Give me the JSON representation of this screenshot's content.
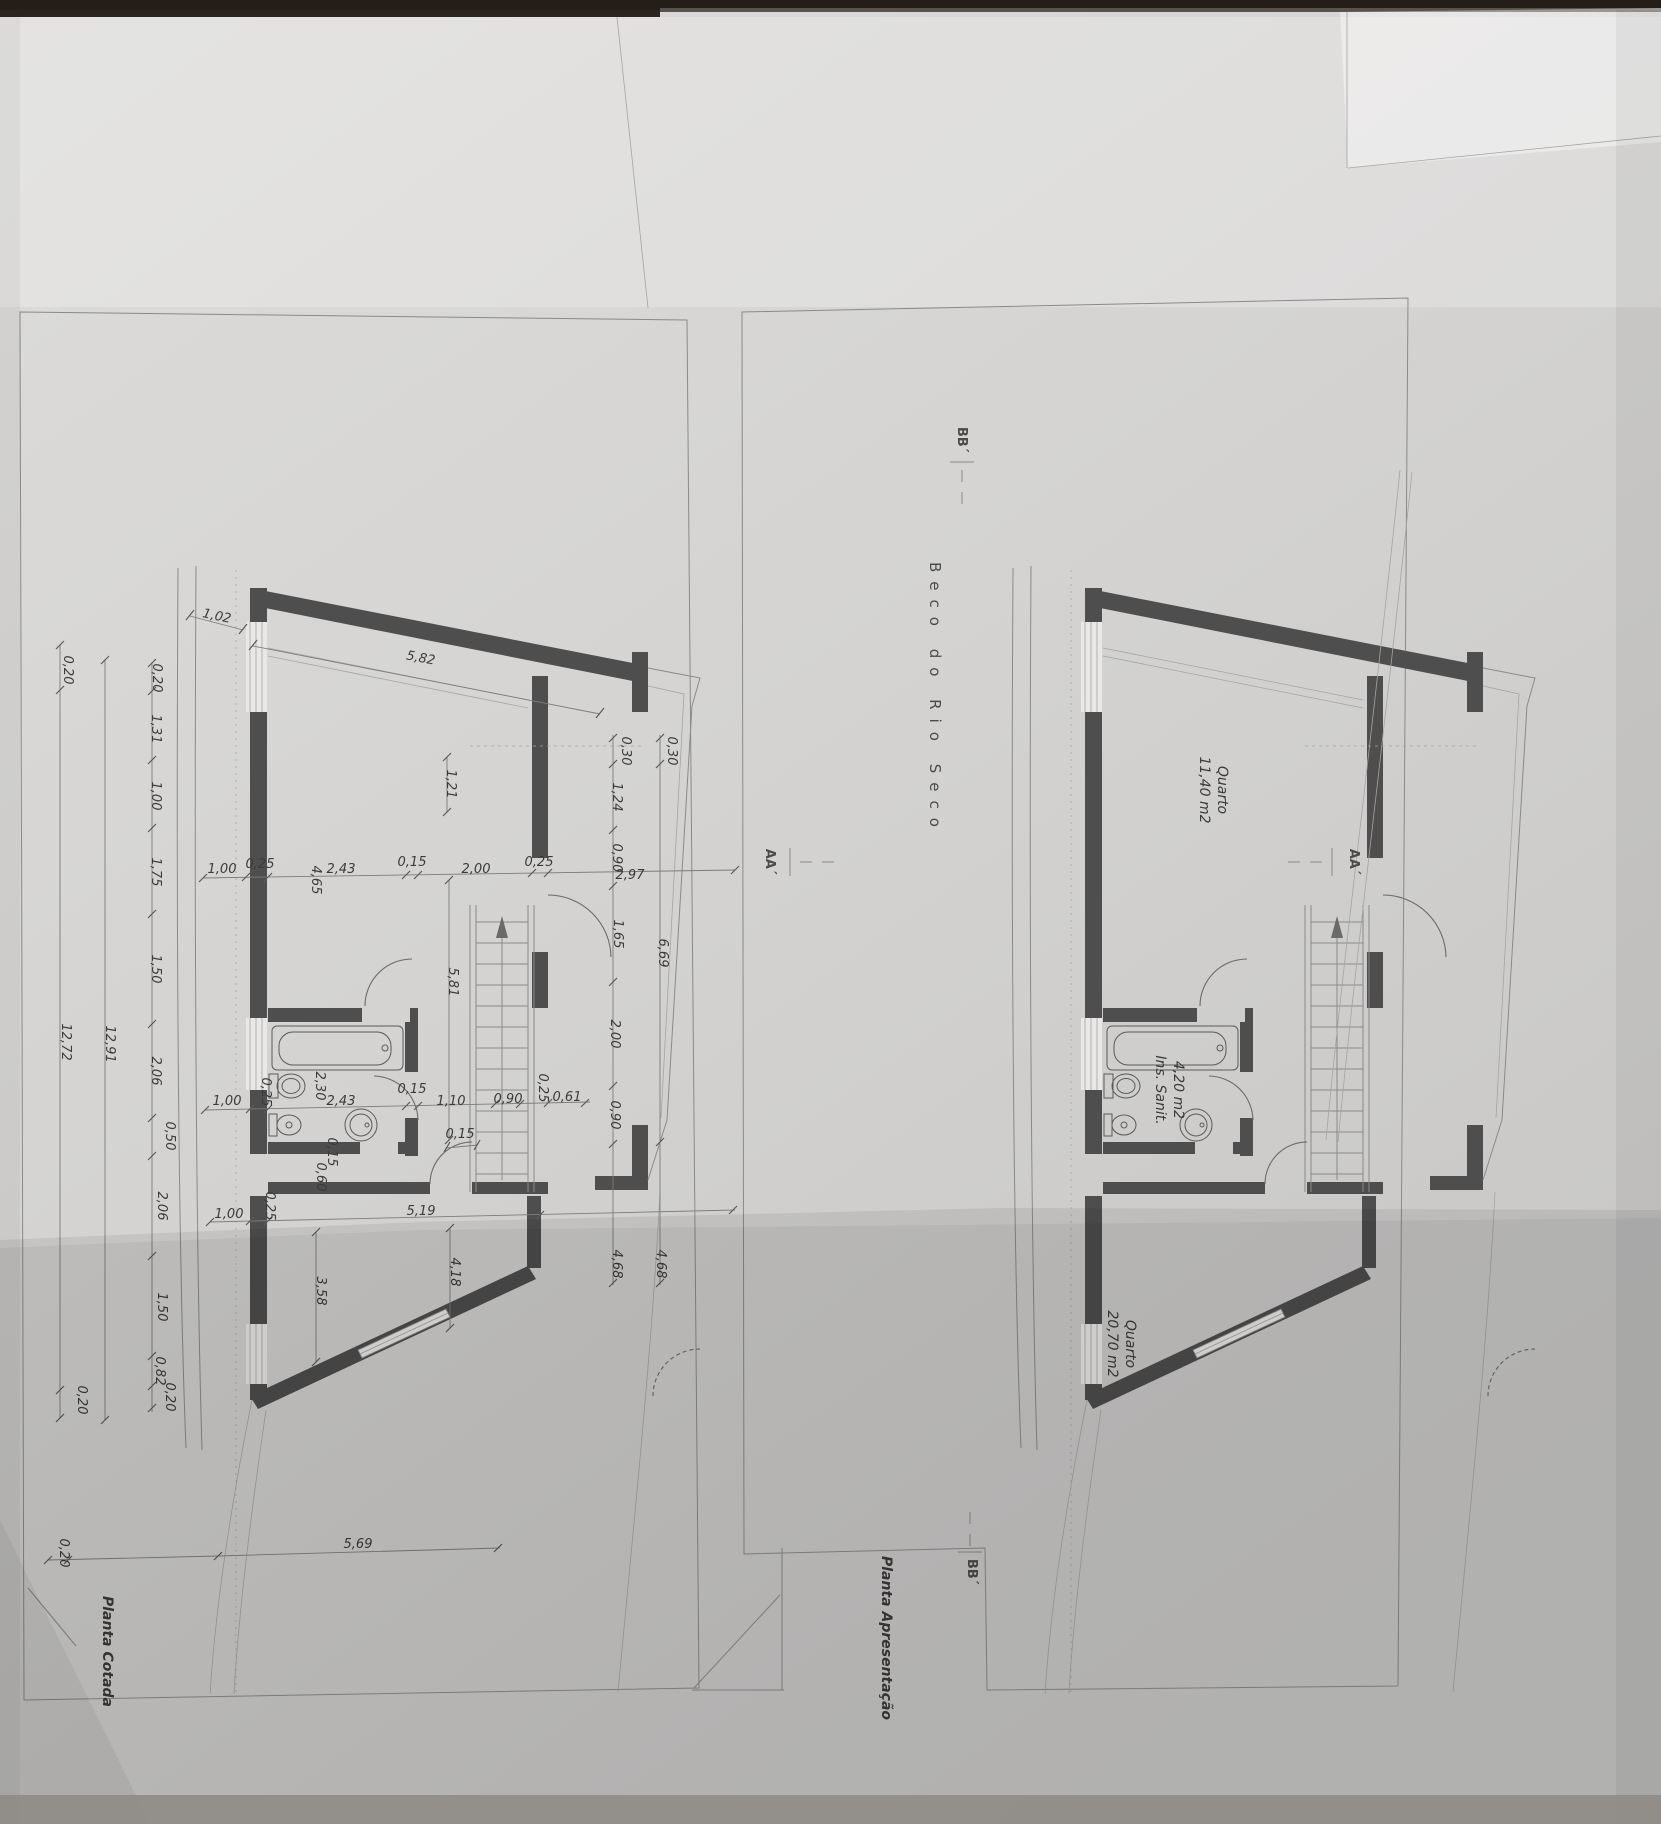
{
  "colors": {
    "paper": "#d6d5d3",
    "ink": "#3b3b3b",
    "wall": "#4e4e4e",
    "top_strip": "#241e19"
  },
  "street_label": "Beco do Rio Seco",
  "plans": {
    "cotada": {
      "title": "Planta Cotada",
      "dims": {
        "d1_02": "1,02",
        "d5_82": "5,82",
        "chain_outer": [
          "0,20",
          "12,72",
          "0,20"
        ],
        "chain_total": "12,91",
        "chain_inner": [
          "0,20",
          "1,31",
          "1,00",
          "1,75",
          "1,50",
          "2,06",
          "0,50",
          "2,06",
          "1,50",
          "0,82",
          "0,20"
        ],
        "mid": [
          "1,00",
          "0,25",
          "4,65",
          "2,43",
          "0,15",
          "2,00",
          "0,25",
          "2,97"
        ],
        "right_inner": [
          "0,30",
          "1,24",
          "0,90",
          "1,65",
          "2,00",
          "0,90",
          "4,68"
        ],
        "right_outer": [
          "0,30",
          "6,69",
          "4,68"
        ],
        "room": [
          "1,21",
          "5,81"
        ],
        "bath": [
          "1,00",
          "0,25",
          "2,30",
          "2,43",
          "0,15",
          "1,10",
          "0,90",
          "0,25",
          "0,61"
        ],
        "below_bath": [
          "0,15",
          "0,60",
          "0,15"
        ],
        "bottom": [
          "1,00",
          "0,25",
          "5,19",
          "4,18",
          "3,58"
        ],
        "base": [
          "0,20",
          "5,69"
        ]
      }
    },
    "apresentacao": {
      "title": "Planta Apresentação",
      "rooms": [
        {
          "name": "Quarto",
          "area": "11,40 m2"
        },
        {
          "name": "Ins. Sanit.",
          "area": "4,20 m2"
        },
        {
          "name": "Quarto",
          "area": "20,70 m2"
        }
      ],
      "sections": {
        "aa": "AA´",
        "bb": "BB´"
      }
    }
  }
}
